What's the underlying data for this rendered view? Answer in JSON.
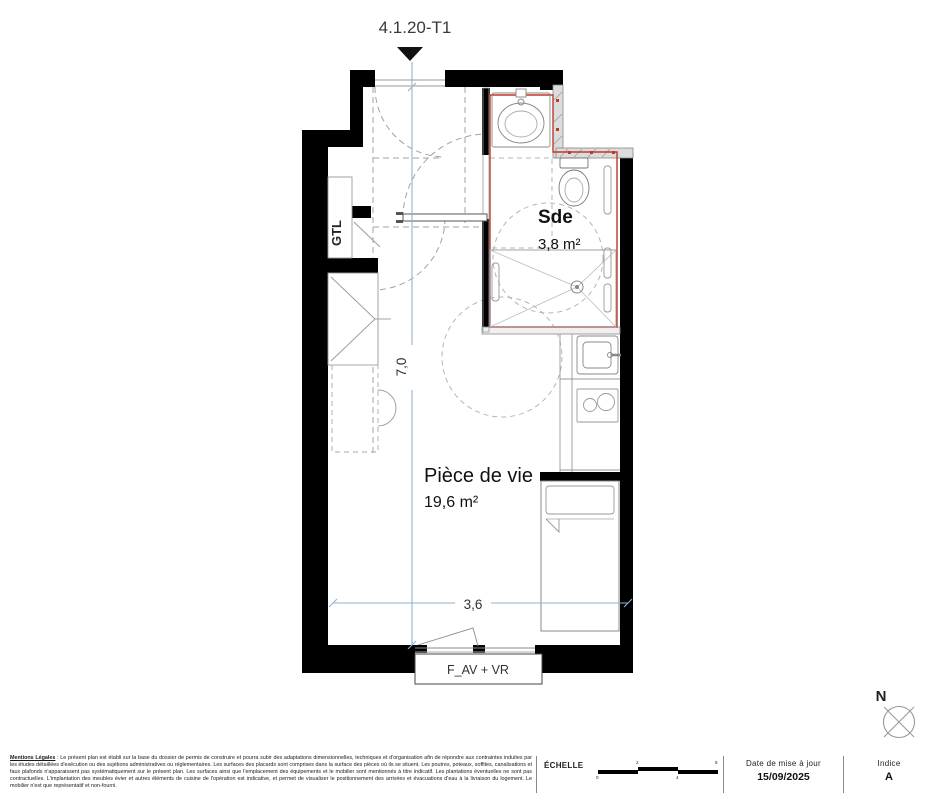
{
  "title": {
    "label": "4.1.20-T1"
  },
  "plan": {
    "colors": {
      "wall": "#000000",
      "red_outline": "#c0392b",
      "dimension_blue": "#93b2cc",
      "dashed_gray": "#a3a3a3"
    },
    "rooms": [
      {
        "name": "Sde",
        "area": "3,8 m²"
      },
      {
        "name": "Pièce de vie",
        "area": "19,6 m²"
      }
    ],
    "annotations": {
      "gtl": "GTL",
      "window": "F_AV + VR"
    },
    "dimensions": {
      "horizontal": "3,6",
      "vertical": "7,0"
    },
    "compass": {
      "north": "N"
    }
  },
  "footer": {
    "legal": {
      "title": "Mentions Légales",
      "body": " : Le présent plan est établi sur la base du dossier de permis de construire et pourra subir des adaptations dimensionnelles, techniques et d'organisation afin de répondre aux contraintes induites par les études détaillées d'exécution ou des sujétions administratives ou réglementaires. Les surfaces des placards sont comprises dans la surface des pièces où ils se situent. Les poutres, poteaux, soffites, canalisations et faux plafonds n'apparaissent pas systématiquement sur le présent plan. Les surfaces ainsi que l'emplacement des équipements et le mobilier sont mentionnés à titre indicatif. Les plantations éventuelles ne sont pas contractuelles. L'implantation des meubles évier et autres éléments de cuisine de l'opération est indicative, et permet de visualiser le positionnement des arrivées et évacuations d'eau à la livraison du logement. Le mobilier n'est que représentatif et non-fourni."
    },
    "scale": {
      "label": "ÉCHELLE",
      "ticks": [
        "0",
        "2",
        "4",
        "8"
      ]
    },
    "date": {
      "label": "Date de mise à jour",
      "value": "15/09/2025"
    },
    "index": {
      "label": "Indice",
      "value": "A"
    }
  }
}
